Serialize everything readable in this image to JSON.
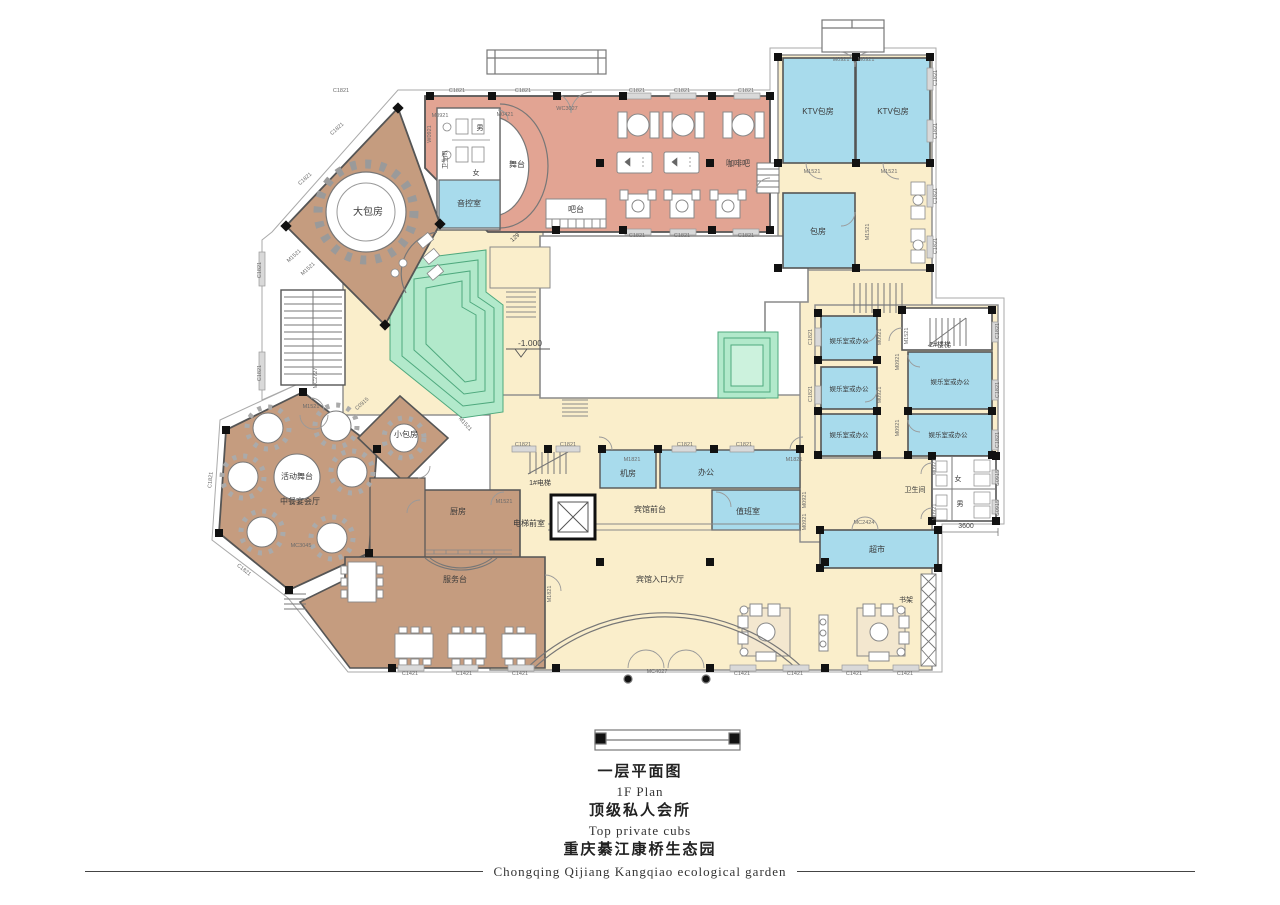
{
  "palette": {
    "bar_area": "#e2a493",
    "dining_brown": "#c59c7f",
    "room_blue": "#a8dbec",
    "corridor_cream": "#faeecb",
    "terrace_green": "#b2e9cb",
    "terrace_line": "#4fa97e",
    "wall": "#555555",
    "column_black": "#111111",
    "window_gray": "#d9d9d9"
  },
  "plan": {
    "rooms": [
      {
        "name": "large-private-room",
        "label": "大包房",
        "x": 368,
        "y": 215,
        "s": 10
      },
      {
        "name": "stage",
        "label": "舞台",
        "x": 517,
        "y": 167,
        "s": 8
      },
      {
        "name": "sound-control-room",
        "label": "音控室",
        "x": 469,
        "y": 206,
        "s": 8
      },
      {
        "name": "mens-toilet-top",
        "label": "男",
        "x": 480,
        "y": 130,
        "s": 7
      },
      {
        "name": "womens-toilet-top",
        "label": "女",
        "x": 476,
        "y": 175,
        "s": 7
      },
      {
        "name": "toilet-room-top",
        "label": "卫生间",
        "x": 447,
        "y": 160,
        "s": 6,
        "r": -90
      },
      {
        "name": "bar-counter-label",
        "label": "吧台",
        "x": 576,
        "y": 212,
        "s": 8
      },
      {
        "name": "coffee-bar",
        "label": "咖啡吧",
        "x": 738,
        "y": 166,
        "s": 8
      },
      {
        "name": "ktv-room-1",
        "label": "KTV包房",
        "x": 818,
        "y": 114,
        "s": 8
      },
      {
        "name": "ktv-room-2",
        "label": "KTV包房",
        "x": 893,
        "y": 114,
        "s": 8
      },
      {
        "name": "private-room",
        "label": "包房",
        "x": 818,
        "y": 234,
        "s": 8
      },
      {
        "name": "rec-office-1",
        "label": "娱乐室或办公",
        "x": 849,
        "y": 343,
        "s": 6.5
      },
      {
        "name": "rec-office-2",
        "label": "娱乐室或办公",
        "x": 849,
        "y": 391,
        "s": 6.5
      },
      {
        "name": "rec-office-3",
        "label": "娱乐室或办公",
        "x": 849,
        "y": 437,
        "s": 6.5
      },
      {
        "name": "rec-office-4",
        "label": "娱乐室或办公",
        "x": 950,
        "y": 384,
        "s": 6.5
      },
      {
        "name": "rec-office-5",
        "label": "娱乐室或办公",
        "x": 948,
        "y": 437,
        "s": 6.5
      },
      {
        "name": "stair-2-label",
        "label": "2#楼梯",
        "x": 940,
        "y": 347,
        "s": 7
      },
      {
        "name": "machine-room",
        "label": "机房",
        "x": 628,
        "y": 476,
        "s": 8
      },
      {
        "name": "office-room",
        "label": "办公",
        "x": 706,
        "y": 475,
        "s": 8
      },
      {
        "name": "duty-room",
        "label": "值班室",
        "x": 748,
        "y": 514,
        "s": 8
      },
      {
        "name": "hotel-front-desk",
        "label": "宾馆前台",
        "x": 650,
        "y": 512,
        "s": 8
      },
      {
        "name": "elevator-1-label",
        "label": "1#电梯",
        "x": 540,
        "y": 485,
        "s": 7
      },
      {
        "name": "elevator-lobby",
        "label": "电梯前室",
        "x": 529,
        "y": 526,
        "s": 8
      },
      {
        "name": "hotel-entrance-hall",
        "label": "宾馆入口大厅",
        "x": 660,
        "y": 582,
        "s": 8
      },
      {
        "name": "toilet-room-bottom",
        "label": "卫生间",
        "x": 915,
        "y": 492,
        "s": 7
      },
      {
        "name": "womens-toilet-bottom",
        "label": "女",
        "x": 958,
        "y": 481,
        "s": 7
      },
      {
        "name": "mens-toilet-bottom",
        "label": "男",
        "x": 960,
        "y": 506,
        "s": 7
      },
      {
        "name": "supermarket",
        "label": "超市",
        "x": 877,
        "y": 552,
        "s": 8
      },
      {
        "name": "bookshelf-label",
        "label": "书架",
        "x": 906,
        "y": 602,
        "s": 7
      },
      {
        "name": "small-private-room",
        "label": "小包房",
        "x": 406,
        "y": 437,
        "s": 8
      },
      {
        "name": "kitchen",
        "label": "厨房",
        "x": 458,
        "y": 514,
        "s": 8
      },
      {
        "name": "service-desk-label",
        "label": "服务台",
        "x": 455,
        "y": 582,
        "s": 8
      },
      {
        "name": "chinese-banquet-hall",
        "label": "中餐宴会厅",
        "x": 300,
        "y": 504,
        "s": 8
      },
      {
        "name": "activity-stage",
        "label": "活动舞台",
        "x": 297,
        "y": 479,
        "s": 8
      }
    ],
    "codes": [
      {
        "code": "C1821",
        "x": 341,
        "y": 92
      },
      {
        "code": "C1821",
        "x": 457,
        "y": 92
      },
      {
        "code": "C1821",
        "x": 523,
        "y": 92
      },
      {
        "code": "C1821",
        "x": 637,
        "y": 92
      },
      {
        "code": "C1821",
        "x": 682,
        "y": 92
      },
      {
        "code": "C1821",
        "x": 746,
        "y": 92
      },
      {
        "code": "C1821",
        "x": 637,
        "y": 237
      },
      {
        "code": "C1821",
        "x": 682,
        "y": 237
      },
      {
        "code": "C1821",
        "x": 746,
        "y": 237
      },
      {
        "code": "C1821",
        "x": 338,
        "y": 130,
        "r": -42
      },
      {
        "code": "C1821",
        "x": 306,
        "y": 180,
        "r": -42
      },
      {
        "code": "C1821",
        "x": 261,
        "y": 270,
        "r": -90
      },
      {
        "code": "C1821",
        "x": 261,
        "y": 373,
        "r": -90
      },
      {
        "code": "C1821",
        "x": 937,
        "y": 78,
        "r": -90
      },
      {
        "code": "C1821",
        "x": 937,
        "y": 131,
        "r": -90
      },
      {
        "code": "C1821",
        "x": 937,
        "y": 196,
        "r": -90
      },
      {
        "code": "C1821",
        "x": 937,
        "y": 246,
        "r": -90
      },
      {
        "code": "C1821",
        "x": 999,
        "y": 331,
        "r": -90
      },
      {
        "code": "C1821",
        "x": 999,
        "y": 390,
        "r": -90
      },
      {
        "code": "C1821",
        "x": 999,
        "y": 440,
        "r": -90
      },
      {
        "code": "C1821",
        "x": 812,
        "y": 337,
        "r": -90
      },
      {
        "code": "C1821",
        "x": 812,
        "y": 394,
        "r": -90
      },
      {
        "code": "C1821",
        "x": 523,
        "y": 446
      },
      {
        "code": "C1821",
        "x": 568,
        "y": 446
      },
      {
        "code": "C1821",
        "x": 685,
        "y": 446
      },
      {
        "code": "C1821",
        "x": 744,
        "y": 446
      },
      {
        "code": "C1821",
        "x": 212,
        "y": 480,
        "r": -85
      },
      {
        "code": "C1821",
        "x": 243,
        "y": 571,
        "r": 38
      },
      {
        "code": "C1421",
        "x": 410,
        "y": 675
      },
      {
        "code": "C1421",
        "x": 464,
        "y": 675
      },
      {
        "code": "C1421",
        "x": 520,
        "y": 675
      },
      {
        "code": "C1421",
        "x": 742,
        "y": 675
      },
      {
        "code": "C1421",
        "x": 795,
        "y": 675
      },
      {
        "code": "C1421",
        "x": 854,
        "y": 675
      },
      {
        "code": "C1421",
        "x": 905,
        "y": 675
      },
      {
        "code": "C0915",
        "x": 363,
        "y": 405,
        "r": -42
      },
      {
        "code": "C0915",
        "x": 999,
        "y": 478,
        "r": -90
      },
      {
        "code": "C0915",
        "x": 999,
        "y": 508,
        "r": -90
      },
      {
        "code": "M1521",
        "x": 812,
        "y": 173
      },
      {
        "code": "M1521",
        "x": 889,
        "y": 173
      },
      {
        "code": "M1521",
        "x": 869,
        "y": 232,
        "r": -90
      },
      {
        "code": "M1521",
        "x": 311,
        "y": 408
      },
      {
        "code": "M1521",
        "x": 504,
        "y": 503
      },
      {
        "code": "M1521",
        "x": 908,
        "y": 336,
        "r": -90
      },
      {
        "code": "M1521",
        "x": 295,
        "y": 257,
        "r": -42
      },
      {
        "code": "M1521",
        "x": 309,
        "y": 270,
        "r": -42
      },
      {
        "code": "M1521",
        "x": 464,
        "y": 425,
        "r": 48
      },
      {
        "code": "M0921",
        "x": 440,
        "y": 117
      },
      {
        "code": "M0921",
        "x": 841,
        "y": 61
      },
      {
        "code": "M0921",
        "x": 866,
        "y": 61
      },
      {
        "code": "M0921",
        "x": 881,
        "y": 337,
        "r": -90
      },
      {
        "code": "M0921",
        "x": 881,
        "y": 395,
        "r": -90
      },
      {
        "code": "M0921",
        "x": 899,
        "y": 362,
        "r": -90
      },
      {
        "code": "M0921",
        "x": 899,
        "y": 428,
        "r": -90
      },
      {
        "code": "M0921",
        "x": 936,
        "y": 467,
        "r": -90
      },
      {
        "code": "M0921",
        "x": 936,
        "y": 512,
        "r": -90
      },
      {
        "code": "M0921",
        "x": 806,
        "y": 500,
        "r": -90
      },
      {
        "code": "M0921",
        "x": 806,
        "y": 522,
        "r": -90
      },
      {
        "code": "M1821",
        "x": 632,
        "y": 461
      },
      {
        "code": "M1821",
        "x": 794,
        "y": 461
      },
      {
        "code": "M1821",
        "x": 551,
        "y": 594,
        "r": -90
      },
      {
        "code": "M0421",
        "x": 505,
        "y": 116
      },
      {
        "code": "W0921",
        "x": 431,
        "y": 134,
        "r": -90
      },
      {
        "code": "WC3027",
        "x": 567,
        "y": 110
      },
      {
        "code": "MC2424",
        "x": 864,
        "y": 524
      },
      {
        "code": "MC3045",
        "x": 301,
        "y": 547
      },
      {
        "code": "MC4027",
        "x": 657,
        "y": 673
      },
      {
        "code": "MC2727",
        "x": 317,
        "y": 378,
        "r": -90
      }
    ],
    "annotations": [
      {
        "name": "level-mark",
        "text": "-1.000",
        "x": 530,
        "y": 346,
        "s": 8.5
      },
      {
        "name": "dimension-3600",
        "text": "3600",
        "x": 966,
        "y": 528,
        "s": 7
      },
      {
        "name": "angle-mark",
        "text": "129°",
        "x": 517,
        "y": 238,
        "s": 6,
        "r": -42
      }
    ]
  },
  "title_block": {
    "line1_cn": "一层平面图",
    "line1_en": "1F Plan",
    "line2_cn": "顶级私人会所",
    "line2_en": "Top private cubs",
    "line3_cn": "重庆綦江康桥生态园",
    "line3_en": "Chongqing Qijiang Kangqiao ecological garden"
  }
}
